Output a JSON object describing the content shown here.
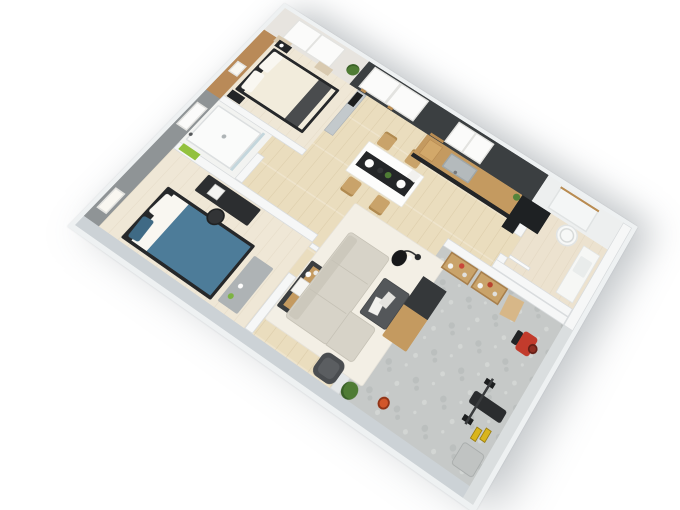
{
  "meta": {
    "description": "3D isometric render of an apartment floor plan viewed from above: two bedrooms, shower room, open living-dining area, kitchen on a dark feature wall, laundry room with water heater, and a home-gym terrace with stone floor",
    "background": "#ffffff"
  },
  "palette": {
    "slab": "#eef1f2",
    "wall-white": "#f6f7f7",
    "wall-edge": "#d9dcde",
    "wall-gray": "#8f9496",
    "wall-light": "#ccd2d6",
    "wall-dark": "#3b3f41",
    "wall-wood": "#b98a58",
    "wall-outer-se": "#dadedf",
    "floor-wood": "#eaddbe",
    "floor-cream": "#efe7d6",
    "floor-tile": "#f2f3f1",
    "floor-stone": "#c6c9c8",
    "floor-bath": "#ece2cf",
    "stone-light": "#d3d6d4",
    "stone-dark": "#bbbfbe",
    "window-white": "#fbfbfa",
    "window-frame": "#e3e3e0",
    "curtain": "#d9cab0",
    "sill-tan": "#b98c52",
    "ledge-gray": "#c3c9cc",
    "tv-black": "#1c1e1f",
    "partition-black": "#2b2e30",
    "sofa": "#d7d3c8",
    "sofa-edge": "#c6c2b6",
    "rug": "#f3efe5",
    "coffee-table": "#54575a",
    "armchair": "#4a4d50",
    "table-white": "#fdfdfc",
    "runner-black": "#242628",
    "chair-wood": "#c9a36a",
    "book-white": "#f2f1ee",
    "console-dark": "#3b3e40",
    "wood-furniture": "#c49a60",
    "dark-furniture": "#232527",
    "bed-frame": "#26282a",
    "duvet-white": "#f2ecdc",
    "pillow-white": "#f9f7f1",
    "throw-gray": "#4a4c4e",
    "duvet-blue": "#4d7c99",
    "pillow-blue": "#3f6a85",
    "bench-gray": "#aeb3b5",
    "desk-black": "#2c2e30",
    "towel-green": "#93c13e",
    "plant-green": "#4f7c35",
    "plant-light": "#7cb342",
    "steel": "#b4babc",
    "steel-dark": "#9fa6a8",
    "counter-white": "#f6f7f5",
    "basin-gray": "#e9eceb",
    "mat-tan": "#d7b788",
    "bike-red": "#c23b2c",
    "kettlebell-orange": "#d2562a",
    "dumbbell-yellow": "#d9b51c",
    "machine-gray": "#c0c3c2",
    "glass-blue": "rgba(150,185,200,0.5)",
    "boiler-white": "#f7f8f7"
  },
  "rooms": [
    {
      "id": "bedroom-main",
      "name": "Main bedroom with wood accent wall, double bed, nightstands, curtained window, TV on half wall"
    },
    {
      "id": "shower-room",
      "name": "Shower room with walk-in shower, glass screen, green towels and frosted window"
    },
    {
      "id": "bedroom-second",
      "name": "Second bedroom with blue double bed, black desk, office chair and gray bench"
    },
    {
      "id": "living-dining",
      "name": "Open living-dining room with L-shaped sofa, coffee table, rug, arc lamp, sideboard, armchair and dining table for four"
    },
    {
      "id": "kitchen",
      "name": "Kitchen with oak counter, dark cabinets, sink, cutting board and tall black unit on the charcoal feature wall"
    },
    {
      "id": "laundry-bathroom",
      "name": "Laundry bathroom with round water heater, white counter basin and window opening"
    },
    {
      "id": "gym-terrace",
      "name": "Home-gym terrace with stone floor, media wall, wooden console, storage shelves and fitness equipment"
    }
  ],
  "furniture": {
    "bedroom_main": [
      "black-frame double bed with white duvet and dark throw",
      "two black nightstands",
      "wall art frame",
      "hanging plant",
      "TV on gray half wall",
      "curtained window"
    ],
    "shower_room": [
      "walk-in shower tray with drain",
      "glass screen",
      "green towels",
      "frosted window"
    ],
    "bedroom_second": [
      "double bed with blue duvet, blue and white pillows",
      "black desk with laptop",
      "black office chair",
      "gray bedroom bench",
      "wall art frame"
    ],
    "living_dining": [
      "L-shaped light sofa",
      "dark coffee table with white books",
      "cream rug",
      "black arc floor lamp",
      "dark armchair",
      "sideboard with oak drawers and decor",
      "potted plant",
      "white dining table",
      "black table runner with place settings",
      "four oak chairs"
    ],
    "kitchen": [
      "oak worktop with dark base cabinets",
      "stainless sink",
      "cutting board",
      "utensil rail",
      "tall black cabinet",
      "counter plant"
    ],
    "laundry_bathroom": [
      "cylindrical water heater",
      "white counter with basin",
      "door leaf",
      "window opening with oak sill"
    ],
    "gym_terrace": [
      "charcoal media wall with TV",
      "wooden console with dark drawers",
      "two oak storage shelves with gear",
      "tan doormat",
      "orange kettlebell",
      "red exercise bike",
      "black weight bench with barbell",
      "yellow dumbbells",
      "gray folded machine",
      "potted plant"
    ]
  }
}
